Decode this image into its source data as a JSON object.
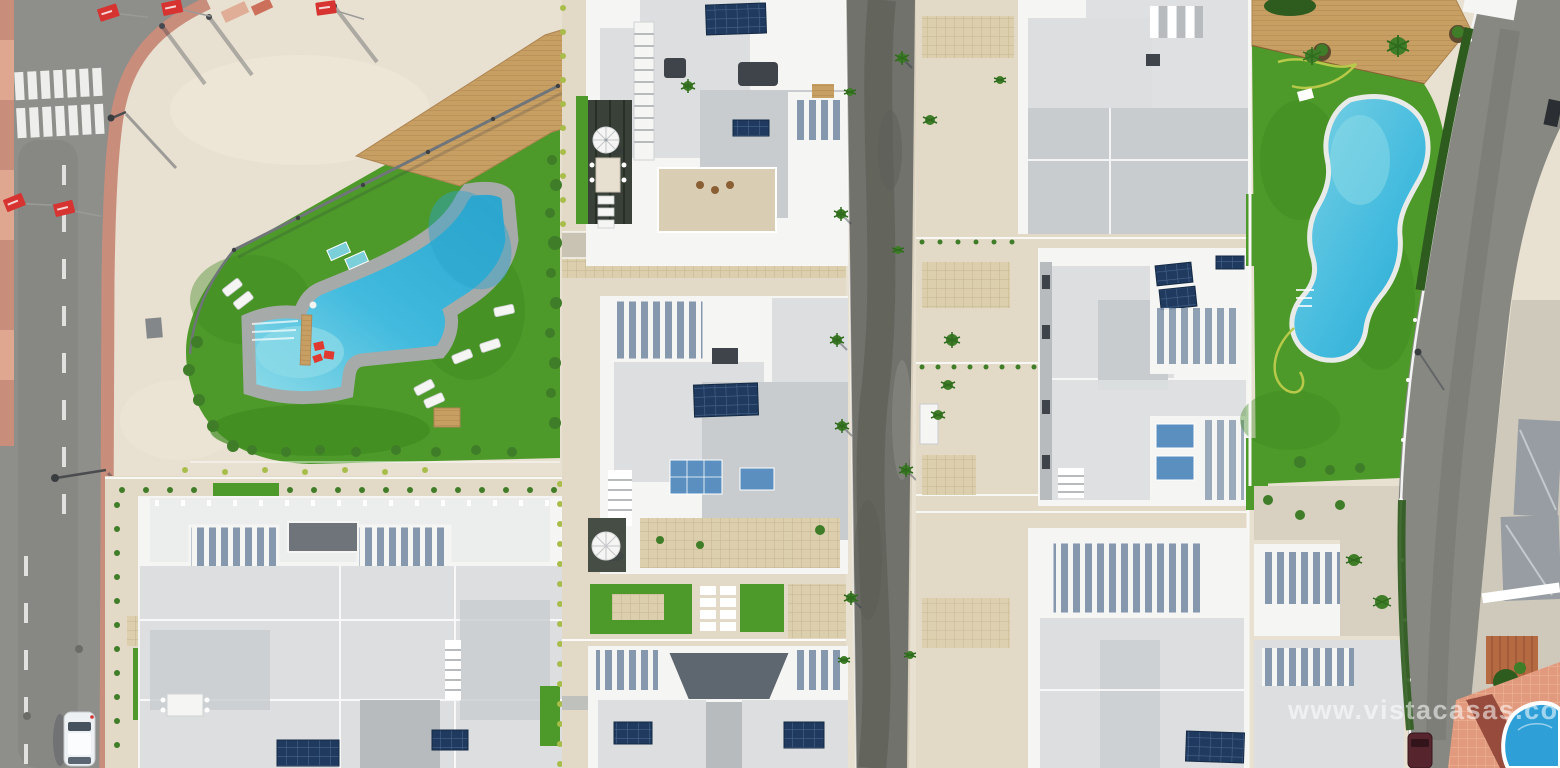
{
  "scene": {
    "description": "Aerial drone photo of a new-build residential complex: white flat-roofed villas with solar panels, two communal pools on artificial lawns, sandy plots, an asphalt street with zebra crossing on the left and an older town corner at bottom right.",
    "watermark": "www.vistacasas.com"
  },
  "features": [
    "perimeter-street",
    "zebra-crossing",
    "parked-white-car",
    "street-lamps",
    "red-flags",
    "promenade-plaza",
    "communal-garden-left",
    "swimming-pool-left",
    "sun-loungers",
    "wooden-deck",
    "villa-blocks-center",
    "patio-umbrellas",
    "solar-panels",
    "construction-road",
    "villa-blocks-right",
    "communal-garden-right",
    "swimming-pool-right",
    "garden-hose",
    "perimeter-road-right",
    "old-town-corner",
    "corner-plunge-pool",
    "parked-maroon-car",
    "photo-watermark"
  ],
  "colors": {
    "sand": "#e8e0d0",
    "plot_sand": "#e2d9c7",
    "plaza_light": "#f0e9da",
    "road": "#8e8e8a",
    "road_dark": "#7c7c78",
    "center_road": "#71726c",
    "center_road_dark": "#5c5d56",
    "right_road": "#878882",
    "sidewalk_pink": "#c98d7c",
    "sidewalk_pink_light": "#dfa78f",
    "white_line": "#f7f7f4",
    "lawn": "#4d9a2a",
    "lawn_dark": "#3f8a20",
    "pool_deck": "#a6aaa9",
    "pool_water": "#41bade",
    "pool_deep": "#2aa4cd",
    "pool_shallow": "#8edce8",
    "pool_border": "#e9ebe9",
    "wood": "#c79f63",
    "wood_line": "#ad8451",
    "paver": "#dccfad",
    "paver_line": "#c6b48e",
    "villa_white": "#f5f5f3",
    "roof_light": "#dcdedf",
    "roof_mid": "#c8ccce",
    "roof_gray": "#b7bbbe",
    "pergola_shadow": "#8598ad",
    "dark_box": "#3f444b",
    "solar": "#1f3a5e",
    "solar_line": "#47648c",
    "glass_blue": "#5a8fc0",
    "hedge": "#2e5c1e",
    "bush": "#3f7d28",
    "bush_yellow": "#a8bd4a",
    "flag_red": "#d63331",
    "fence_gray": "#70757a",
    "gravel": "#d8d1c2",
    "path_gray": "#bfc2bc",
    "terracotta": "#b56a42",
    "roof_town": "#979da2",
    "salmon": "#e29a7e",
    "brick_path": "#8e4336",
    "corner_pool": "#2f9fd8",
    "car_white": "#eef1f3",
    "car_glass": "#46525e",
    "car_maroon": "#56242d",
    "shadow": "rgba(45,52,66,0.40)",
    "watermark": "rgba(255,255,255,0.55)"
  }
}
